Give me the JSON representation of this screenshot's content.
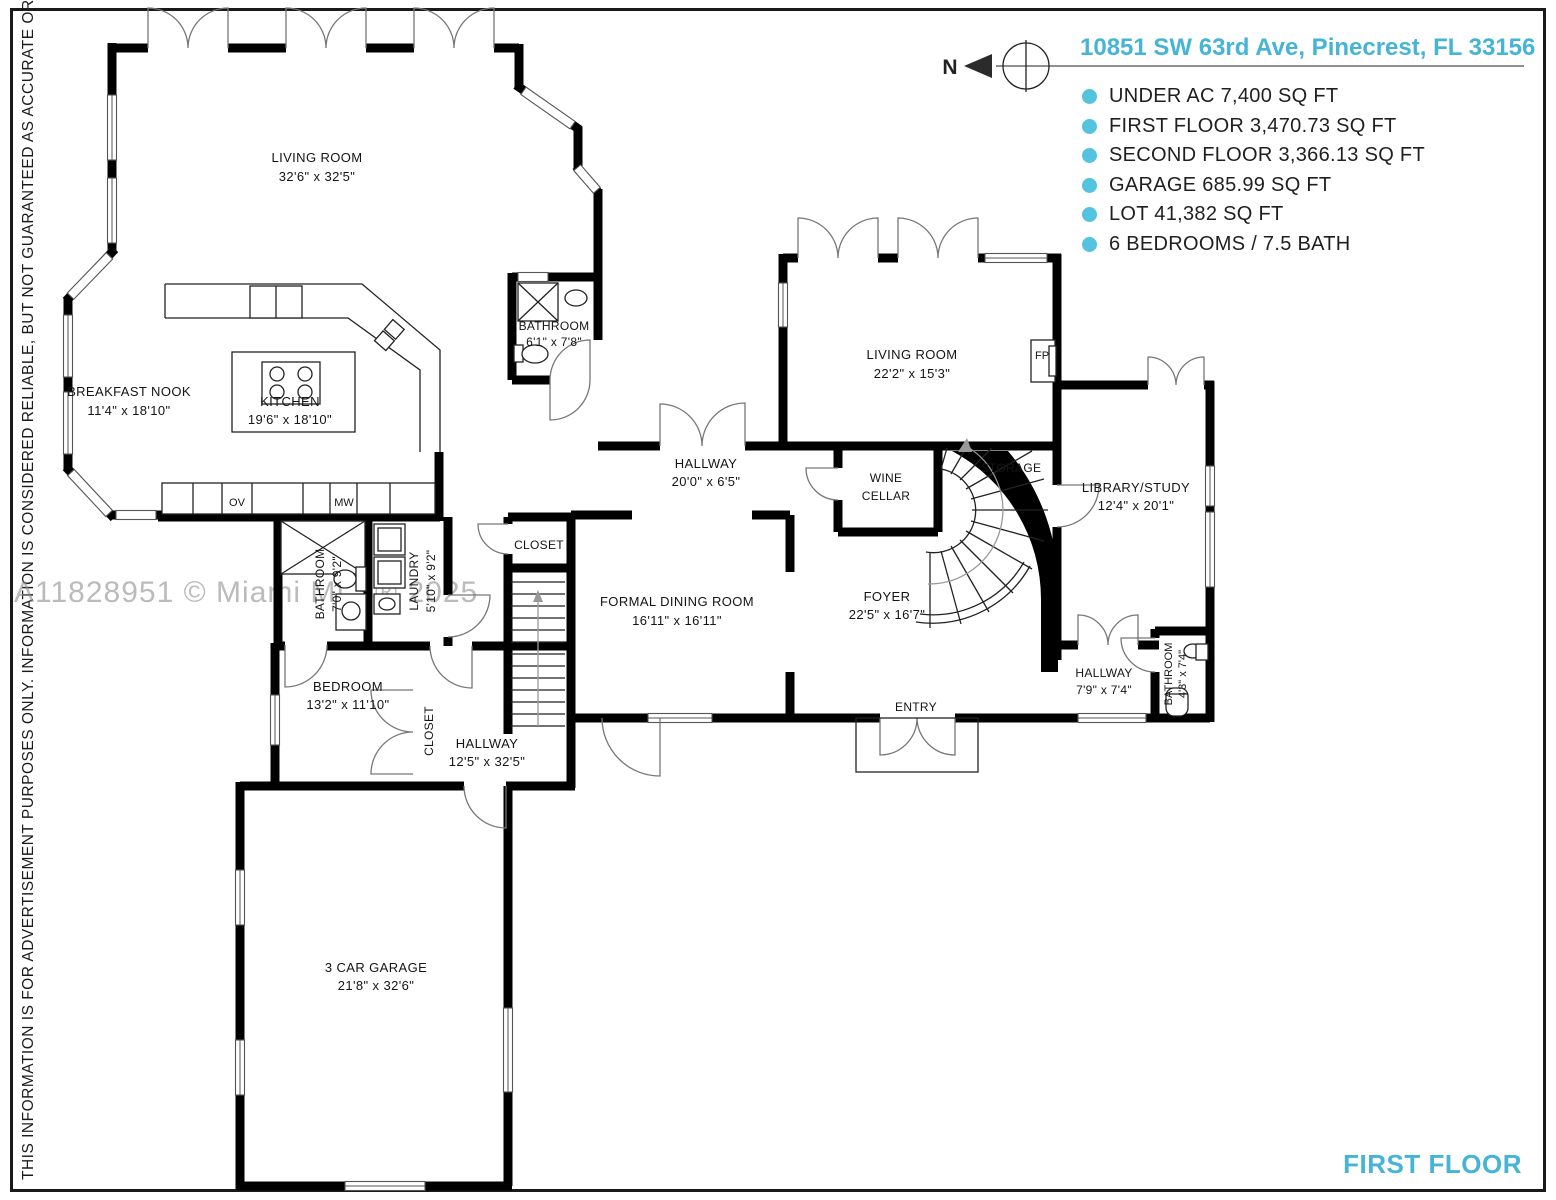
{
  "colors": {
    "accent": "#45b4d6",
    "bullet": "#54c3de",
    "wall": "#000000",
    "watermark": "#8e8e8e"
  },
  "sidebar": {
    "disclaimer": "THIS INFORMATION IS FOR ADVERTISEMENT PURPOSES ONLY. INFORMATION IS CONSIDERED RELIABLE, BUT NOT GUARANTEED AS ACCURATE OR COMPLETE"
  },
  "header": {
    "north_label": "N",
    "address": "10851 SW 63rd Ave, Pinecrest, FL 33156",
    "stats": [
      "UNDER AC 7,400 SQ FT",
      "FIRST FLOOR 3,470.73 SQ FT",
      "SECOND FLOOR 3,366.13 SQ FT",
      "GARAGE 685.99 SQ FT",
      "LOT 41,382 SQ FT",
      "6 BEDROOMS / 7.5 BATH"
    ]
  },
  "watermark": "A11828951 © Miami MLS® 2025",
  "floor_label": "FIRST FLOOR",
  "rooms": {
    "living_room_1": {
      "name": "LIVING ROOM",
      "dims": "32'6\" x 32'5\""
    },
    "breakfast_nook": {
      "name": "BREAKFAST NOOK",
      "dims": "11'4\" x 18'10\""
    },
    "kitchen": {
      "name": "KITCHEN",
      "dims": "19'6\" x 18'10\""
    },
    "bathroom_upper": {
      "name": "BATHROOM",
      "dims": "6'1\" x 7'8\""
    },
    "hallway_main": {
      "name": "HALLWAY",
      "dims": "20'0\" x 6'5\""
    },
    "living_room_2": {
      "name": "LIVING ROOM",
      "dims": "22'2\" x 15'3\""
    },
    "fireplace": {
      "abbr": "FP"
    },
    "wine_cellar": {
      "line1": "WINE",
      "line2": "CELLAR"
    },
    "storage": {
      "name": "STORAGE"
    },
    "library": {
      "name": "LIBRARY/STUDY",
      "dims": "12'4\" x 20'1\""
    },
    "formal_dining": {
      "name": "FORMAL DINING ROOM",
      "dims": "16'11\" x 16'11\""
    },
    "foyer": {
      "name": "FOYER",
      "dims": "22'5\" x 16'7\""
    },
    "closet_hall": {
      "name": "CLOSET"
    },
    "bathroom_mid": {
      "name": "BATHROOM",
      "dims": "7'0\" x 9'2\""
    },
    "laundry": {
      "name": "LAUNDRY",
      "dims": "5'10\" x 9'2\""
    },
    "bedroom": {
      "name": "BEDROOM",
      "dims": "13'2\" x 11'10\""
    },
    "closet_bedroom": {
      "name": "CLOSET"
    },
    "hallway_lower": {
      "name": "HALLWAY",
      "dims": "12'5\" x 32'5\""
    },
    "entry": {
      "name": "ENTRY"
    },
    "hallway_right": {
      "name": "HALLWAY",
      "dims": "7'9\" x 7'4\""
    },
    "bathroom_right": {
      "name": "BATHROOM",
      "dims": "4'3\" x 7'4\""
    },
    "garage": {
      "name": "3 CAR GARAGE",
      "dims": "21'8\" x 32'6\""
    },
    "oven": {
      "abbr": "OV"
    },
    "microwave": {
      "abbr": "MW"
    }
  }
}
